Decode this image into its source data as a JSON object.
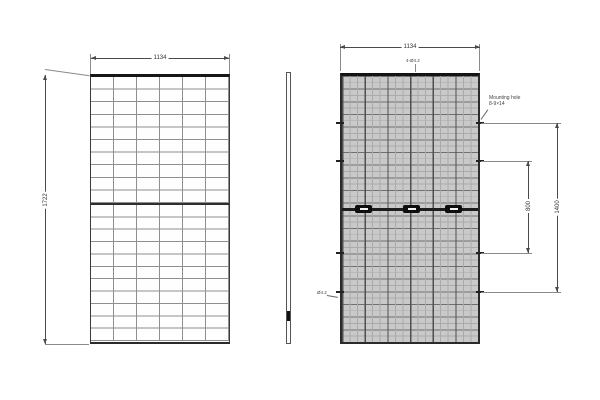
{
  "colors": {
    "line": "#4a4a4a",
    "ext": "#8a8a8a",
    "grid": "#8f8f8f",
    "back-fill": "#c9c9c9",
    "back-dark": "#4f4f4f",
    "back-light": "#aaaaaa",
    "back-hline": "#6f6f6f",
    "jbox": "#0e0e0e"
  },
  "front_view": {
    "width_dim": "1134",
    "height_dim": "1722",
    "grid": {
      "columns": 6,
      "rows_top": 10,
      "rows_bottom": 11
    }
  },
  "back_view": {
    "width_dim": "1134",
    "mount_outer_dim": "1400",
    "mount_inner_dim": "800",
    "mounting_note_line1": "Mounting hole",
    "mounting_note_line2": "8-9×14",
    "top_hole_note": "4-Ø4.2",
    "grounding_note": "Ø4.2",
    "grid": {
      "columns": 6,
      "rows": 21
    },
    "junction_box_count": 3
  }
}
